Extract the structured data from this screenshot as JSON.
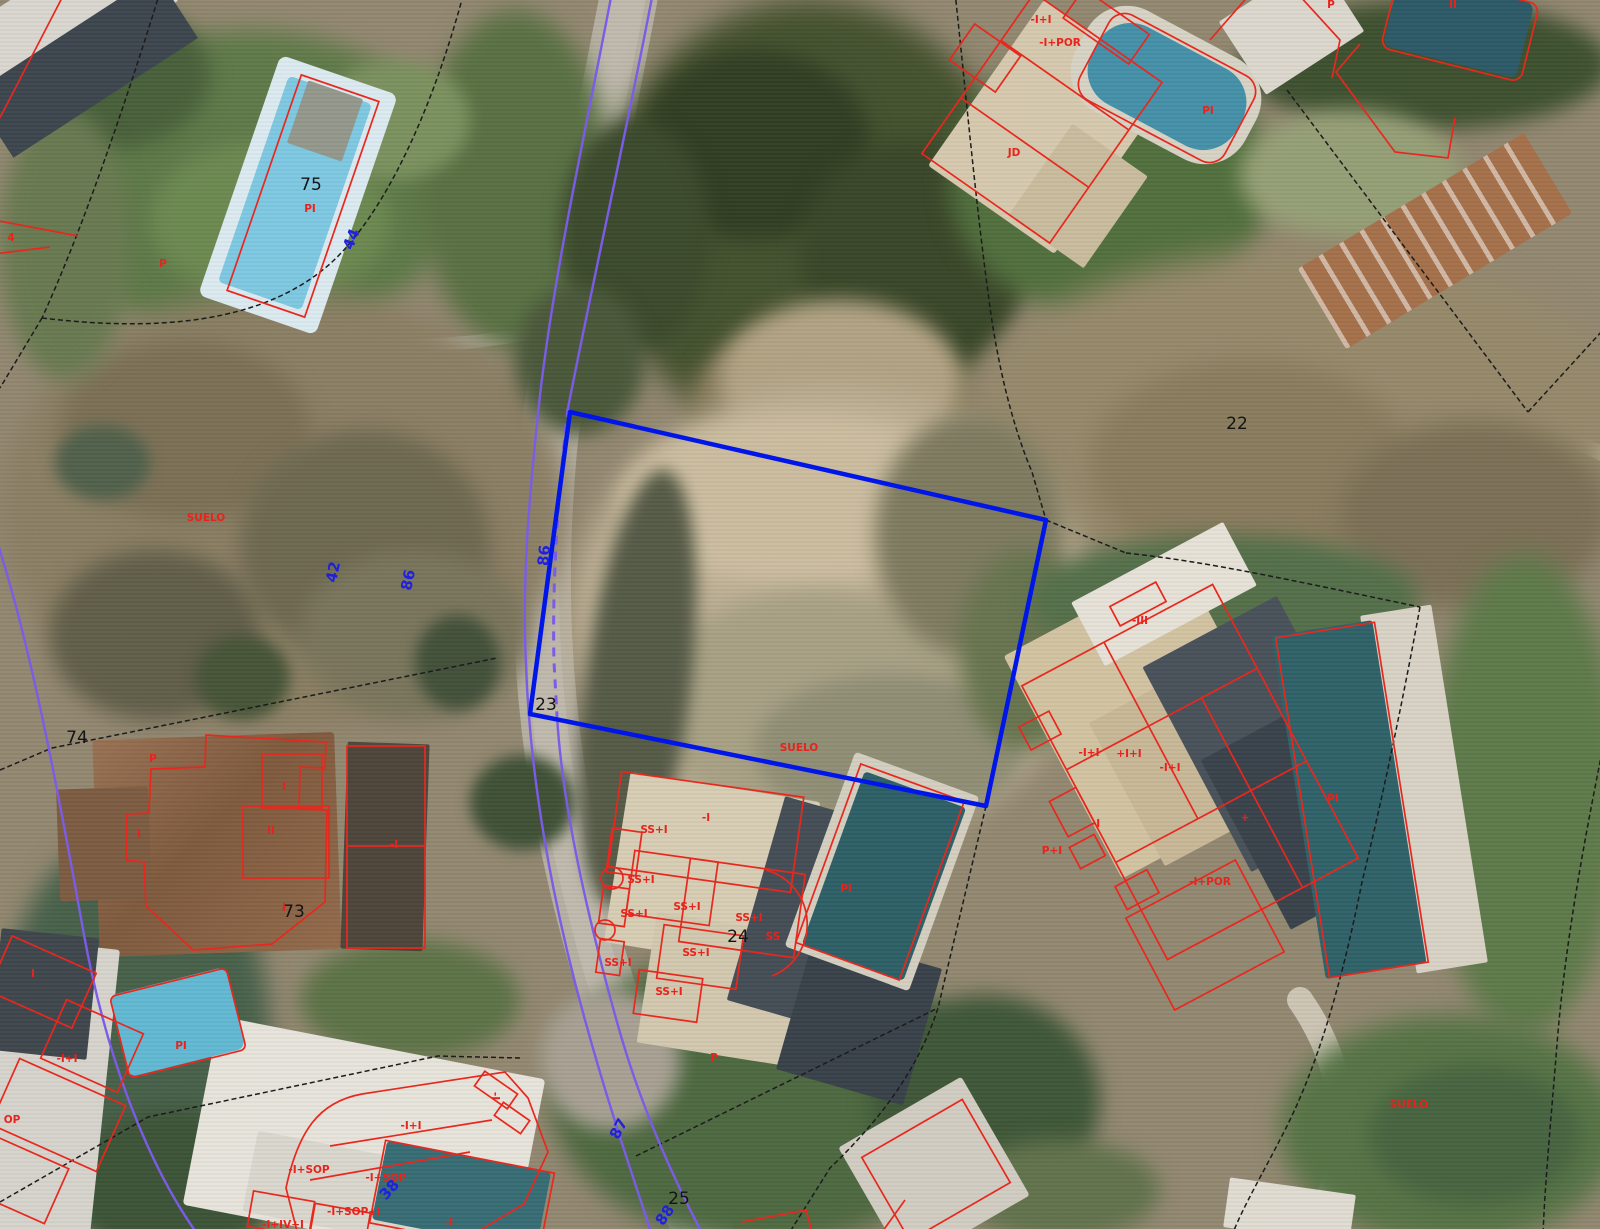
{
  "map_view": {
    "selected_parcel": {
      "number": "23",
      "status_label": "SUELO"
    },
    "visible_parcel_numbers": [
      "22",
      "23",
      "24",
      "25",
      "73",
      "74",
      "75"
    ],
    "blue_boundary_numbers": [
      "38",
      "42",
      "44",
      "86",
      "87",
      "88"
    ],
    "colors": {
      "selected_parcel_outline": "#0016e8",
      "building_outline_red": "#e8281e",
      "road_edge_purple": "#7b5ce6",
      "parcel_boundary_black": "#1c1c1c",
      "number_label_blue": "#2020dd",
      "number_label_black": "#141414"
    }
  },
  "overlay": {
    "labels": [
      {
        "t": "75",
        "x": 311,
        "y": 190,
        "r": 0,
        "c": "k"
      },
      {
        "t": "22",
        "x": 1237,
        "y": 429,
        "r": 0,
        "c": "k"
      },
      {
        "t": "23",
        "x": 546,
        "y": 710,
        "r": 0,
        "c": "k"
      },
      {
        "t": "24",
        "x": 738,
        "y": 942,
        "r": 0,
        "c": "k"
      },
      {
        "t": "25",
        "x": 679,
        "y": 1204,
        "r": 0,
        "c": "k"
      },
      {
        "t": "73",
        "x": 294,
        "y": 917,
        "r": 0,
        "c": "k"
      },
      {
        "t": "74",
        "x": 77,
        "y": 743,
        "r": 0,
        "c": "k"
      },
      {
        "t": "PI",
        "x": 310,
        "y": 212,
        "r": 0,
        "c": "r"
      },
      {
        "t": "SUELO",
        "x": 206,
        "y": 521,
        "r": 0,
        "c": "r"
      },
      {
        "t": "SUELO",
        "x": 799,
        "y": 751,
        "r": 0,
        "c": "r"
      },
      {
        "t": "SUELO",
        "x": 1409,
        "y": 1108,
        "r": 0,
        "c": "r"
      },
      {
        "t": "P",
        "x": 163,
        "y": 267,
        "r": 0,
        "c": "r"
      },
      {
        "t": "4",
        "x": 11,
        "y": 241,
        "r": 0,
        "c": "r"
      },
      {
        "t": "P",
        "x": 153,
        "y": 762,
        "r": 0,
        "c": "r"
      },
      {
        "t": "I",
        "x": 284,
        "y": 790,
        "r": 0,
        "c": "r"
      },
      {
        "t": "II",
        "x": 271,
        "y": 834,
        "r": 0,
        "c": "r"
      },
      {
        "t": "I",
        "x": 139,
        "y": 837,
        "r": 0,
        "c": "r"
      },
      {
        "t": "I",
        "x": 284,
        "y": 911,
        "r": 0,
        "c": "r"
      },
      {
        "t": "-I",
        "x": 394,
        "y": 848,
        "r": 0,
        "c": "r"
      },
      {
        "t": "-I+I",
        "x": 1041,
        "y": 23,
        "r": 0,
        "c": "r"
      },
      {
        "t": "-I+POR",
        "x": 1060,
        "y": 46,
        "r": 0,
        "c": "r"
      },
      {
        "t": "JD",
        "x": 1014,
        "y": 156,
        "r": 0,
        "c": "r"
      },
      {
        "t": "PI",
        "x": 1208,
        "y": 114,
        "r": 0,
        "c": "r"
      },
      {
        "t": "P",
        "x": 1331,
        "y": 8,
        "r": 0,
        "c": "r"
      },
      {
        "t": "II",
        "x": 1453,
        "y": 8,
        "r": 0,
        "c": "r"
      },
      {
        "t": "-III",
        "x": 1140,
        "y": 624,
        "r": 0,
        "c": "r"
      },
      {
        "t": "-I+I",
        "x": 1089,
        "y": 756,
        "r": 0,
        "c": "r"
      },
      {
        "t": "+I+I",
        "x": 1129,
        "y": 757,
        "r": 0,
        "c": "r"
      },
      {
        "t": "-I+I",
        "x": 1170,
        "y": 771,
        "r": 0,
        "c": "r"
      },
      {
        "t": "PI",
        "x": 1333,
        "y": 802,
        "r": 0,
        "c": "r"
      },
      {
        "t": "-I",
        "x": 1096,
        "y": 827,
        "r": 0,
        "c": "r"
      },
      {
        "t": "+",
        "x": 1245,
        "y": 821,
        "r": 0,
        "c": "r"
      },
      {
        "t": "P+I",
        "x": 1052,
        "y": 854,
        "r": 0,
        "c": "r"
      },
      {
        "t": "-I+POR",
        "x": 1210,
        "y": 885,
        "r": 0,
        "c": "r"
      },
      {
        "t": "SS+I",
        "x": 654,
        "y": 833,
        "r": 0,
        "c": "r"
      },
      {
        "t": "-I",
        "x": 706,
        "y": 821,
        "r": 0,
        "c": "r"
      },
      {
        "t": "SS+I",
        "x": 641,
        "y": 883,
        "r": 0,
        "c": "r"
      },
      {
        "t": "SS+I",
        "x": 634,
        "y": 917,
        "r": 0,
        "c": "r"
      },
      {
        "t": "SS+I",
        "x": 687,
        "y": 910,
        "r": 0,
        "c": "r"
      },
      {
        "t": "SS+I",
        "x": 749,
        "y": 921,
        "r": 0,
        "c": "r"
      },
      {
        "t": "SS",
        "x": 773,
        "y": 940,
        "r": 0,
        "c": "r"
      },
      {
        "t": "SS+I",
        "x": 696,
        "y": 956,
        "r": 0,
        "c": "r"
      },
      {
        "t": "SS+I",
        "x": 618,
        "y": 966,
        "r": 0,
        "c": "r"
      },
      {
        "t": "SS+I",
        "x": 669,
        "y": 995,
        "r": 0,
        "c": "r"
      },
      {
        "t": "PI",
        "x": 846,
        "y": 892,
        "r": 0,
        "c": "r"
      },
      {
        "t": "P",
        "x": 714,
        "y": 1061,
        "r": 0,
        "c": "r"
      },
      {
        "t": "I",
        "x": 33,
        "y": 977,
        "r": 0,
        "c": "r"
      },
      {
        "t": "-I+I",
        "x": 67,
        "y": 1062,
        "r": 0,
        "c": "r"
      },
      {
        "t": "OP",
        "x": 12,
        "y": 1123,
        "r": 0,
        "c": "r"
      },
      {
        "t": "PI",
        "x": 181,
        "y": 1049,
        "r": 0,
        "c": "r"
      },
      {
        "t": "-I+I",
        "x": 411,
        "y": 1129,
        "r": 0,
        "c": "r"
      },
      {
        "t": "-I+SOP",
        "x": 309,
        "y": 1173,
        "r": 0,
        "c": "r"
      },
      {
        "t": "-I+SOP",
        "x": 386,
        "y": 1181,
        "r": 0,
        "c": "r"
      },
      {
        "t": "-I+SOP+I",
        "x": 354,
        "y": 1215,
        "r": 0,
        "c": "r"
      },
      {
        "t": "-I+IV+I",
        "x": 283,
        "y": 1228,
        "r": 0,
        "c": "r"
      },
      {
        "t": "-I",
        "x": 449,
        "y": 1225,
        "r": 0,
        "c": "r"
      },
      {
        "t": "-I",
        "x": 492,
        "y": 1096,
        "r": 90,
        "c": "r"
      },
      {
        "t": "44",
        "x": 356,
        "y": 241,
        "r": -68,
        "c": "b"
      },
      {
        "t": "42",
        "x": 338,
        "y": 573,
        "r": -78,
        "c": "b"
      },
      {
        "t": "86",
        "x": 413,
        "y": 581,
        "r": -78,
        "c": "b"
      },
      {
        "t": "86",
        "x": 549,
        "y": 556,
        "r": -84,
        "c": "b"
      },
      {
        "t": "87",
        "x": 623,
        "y": 1131,
        "r": -62,
        "c": "b"
      },
      {
        "t": "88",
        "x": 669,
        "y": 1218,
        "r": -55,
        "c": "b"
      },
      {
        "t": "38",
        "x": 393,
        "y": 1193,
        "r": -48,
        "c": "b"
      }
    ]
  }
}
